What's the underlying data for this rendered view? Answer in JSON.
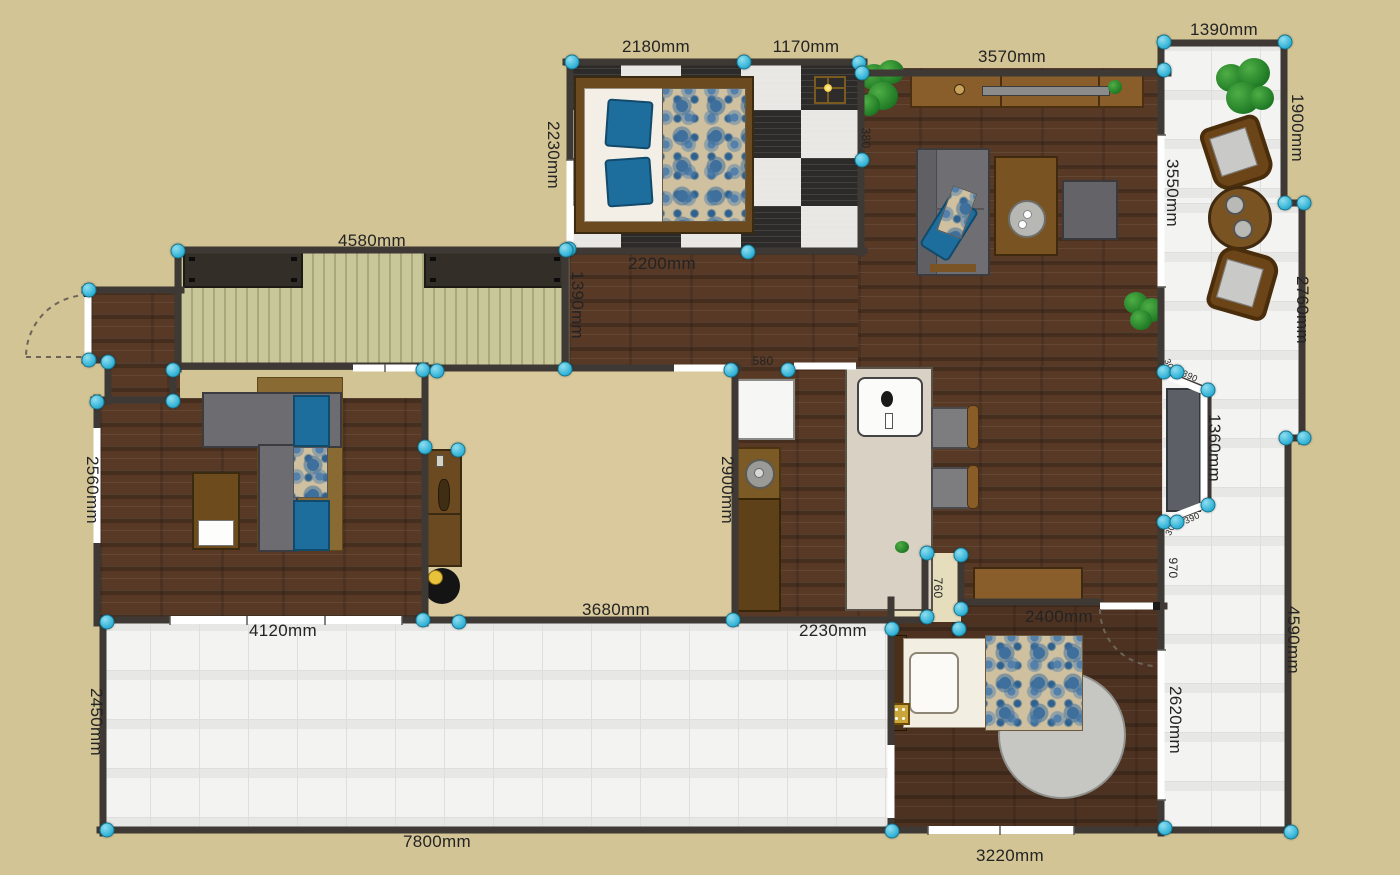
{
  "floorplan": {
    "canvas": {
      "width": 1400,
      "height": 875,
      "background_color": "#d3c495"
    },
    "style": {
      "wall_color": "#3e3934",
      "vertex_handle_color": "#35b4d8",
      "dimension_text_color": "#232323",
      "wood_floor_color": "#573926",
      "tile_floor_color": "#f3f3f1",
      "deck_floor_color": "#c8c79a",
      "courtyard_color": "#d9c99c",
      "accent_blue": "#1e6e9d"
    },
    "units": "mm",
    "dimension_labels": [
      {
        "text": "2180mm",
        "x": 656,
        "y": 47,
        "rotate": 0,
        "size": "md"
      },
      {
        "text": "1170mm",
        "x": 806,
        "y": 47,
        "rotate": 0,
        "size": "md"
      },
      {
        "text": "3570mm",
        "x": 1012,
        "y": 57,
        "rotate": 0,
        "size": "md"
      },
      {
        "text": "1390mm",
        "x": 1224,
        "y": 30,
        "rotate": 0,
        "size": "md"
      },
      {
        "text": "2230mm",
        "x": 553,
        "y": 155,
        "rotate": 90,
        "size": "md"
      },
      {
        "text": "1900mm",
        "x": 1297,
        "y": 128,
        "rotate": 90,
        "size": "md"
      },
      {
        "text": "3550mm",
        "x": 1172,
        "y": 193,
        "rotate": 90,
        "size": "md"
      },
      {
        "text": "380",
        "x": 866,
        "y": 138,
        "rotate": 90,
        "size": "sm"
      },
      {
        "text": "2200mm",
        "x": 662,
        "y": 264,
        "rotate": 0,
        "size": "md"
      },
      {
        "text": "4580mm",
        "x": 372,
        "y": 241,
        "rotate": 0,
        "size": "md"
      },
      {
        "text": "1390mm",
        "x": 577,
        "y": 305,
        "rotate": 90,
        "size": "md"
      },
      {
        "text": "2760mm",
        "x": 1302,
        "y": 310,
        "rotate": 90,
        "size": "md"
      },
      {
        "text": "2560mm",
        "x": 92,
        "y": 490,
        "rotate": 90,
        "size": "md"
      },
      {
        "text": "580",
        "x": 763,
        "y": 361,
        "rotate": 0,
        "size": "sm"
      },
      {
        "text": "2900mm",
        "x": 727,
        "y": 490,
        "rotate": 90,
        "size": "md"
      },
      {
        "text": "1360mm",
        "x": 1214,
        "y": 448,
        "rotate": 90,
        "size": "md"
      },
      {
        "text": "390",
        "x": 1190,
        "y": 376,
        "rotate": 25,
        "size": "xs"
      },
      {
        "text": "30",
        "x": 1169,
        "y": 364,
        "rotate": 65,
        "size": "xs"
      },
      {
        "text": "390",
        "x": 1192,
        "y": 518,
        "rotate": -25,
        "size": "xs"
      },
      {
        "text": "30",
        "x": 1170,
        "y": 530,
        "rotate": -65,
        "size": "xs"
      },
      {
        "text": "970",
        "x": 1173,
        "y": 568,
        "rotate": 90,
        "size": "sm"
      },
      {
        "text": "4590mm",
        "x": 1293,
        "y": 640,
        "rotate": 90,
        "size": "md"
      },
      {
        "text": "2620mm",
        "x": 1175,
        "y": 720,
        "rotate": 90,
        "size": "md"
      },
      {
        "text": "3680mm",
        "x": 616,
        "y": 610,
        "rotate": 0,
        "size": "md"
      },
      {
        "text": "4120mm",
        "x": 283,
        "y": 631,
        "rotate": 0,
        "size": "md"
      },
      {
        "text": "2230mm",
        "x": 833,
        "y": 631,
        "rotate": 0,
        "size": "md"
      },
      {
        "text": "760",
        "x": 938,
        "y": 588,
        "rotate": 90,
        "size": "sm"
      },
      {
        "text": "2400mm",
        "x": 1059,
        "y": 617,
        "rotate": 0,
        "size": "md"
      },
      {
        "text": "2450mm",
        "x": 96,
        "y": 722,
        "rotate": 90,
        "size": "md"
      },
      {
        "text": "7800mm",
        "x": 437,
        "y": 842,
        "rotate": 0,
        "size": "md"
      },
      {
        "text": "3220mm",
        "x": 1010,
        "y": 856,
        "rotate": 0,
        "size": "md"
      }
    ],
    "vertices": [
      [
        572,
        62
      ],
      [
        744,
        62
      ],
      [
        859,
        63
      ],
      [
        862,
        73
      ],
      [
        862,
        160
      ],
      [
        569,
        249
      ],
      [
        748,
        252
      ],
      [
        566,
        250
      ],
      [
        178,
        251
      ],
      [
        89,
        290
      ],
      [
        89,
        360
      ],
      [
        108,
        362
      ],
      [
        97,
        402
      ],
      [
        173,
        370
      ],
      [
        173,
        401
      ],
      [
        565,
        369
      ],
      [
        423,
        370
      ],
      [
        437,
        371
      ],
      [
        425,
        447
      ],
      [
        458,
        450
      ],
      [
        423,
        620
      ],
      [
        459,
        622
      ],
      [
        107,
        622
      ],
      [
        107,
        830
      ],
      [
        733,
        620
      ],
      [
        731,
        370
      ],
      [
        788,
        370
      ],
      [
        927,
        553
      ],
      [
        961,
        555
      ],
      [
        927,
        617
      ],
      [
        961,
        609
      ],
      [
        892,
        629
      ],
      [
        959,
        629
      ],
      [
        892,
        831
      ],
      [
        1165,
        828
      ],
      [
        1291,
        832
      ],
      [
        1164,
        42
      ],
      [
        1285,
        42
      ],
      [
        1164,
        70
      ],
      [
        1285,
        203
      ],
      [
        1304,
        203
      ],
      [
        1286,
        438
      ],
      [
        1304,
        438
      ],
      [
        1164,
        372
      ],
      [
        1177,
        372
      ],
      [
        1208,
        390
      ],
      [
        1208,
        505
      ],
      [
        1164,
        522
      ],
      [
        1177,
        522
      ]
    ]
  }
}
